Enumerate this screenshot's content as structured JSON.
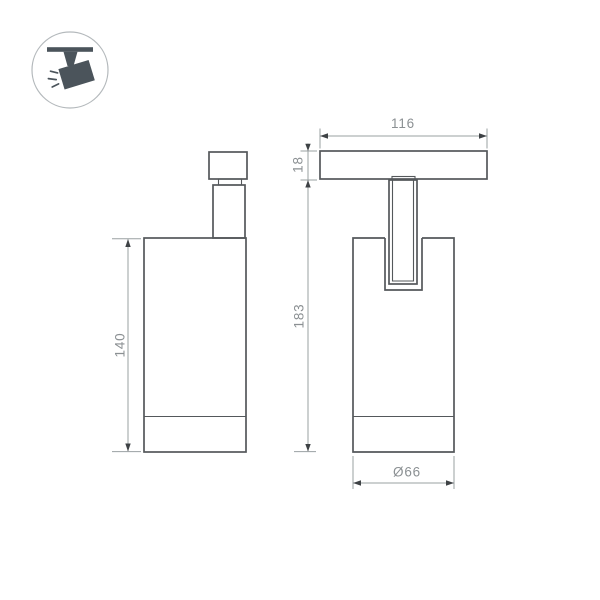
{
  "drawing": {
    "type": "technical-dimension-drawing",
    "subject": "track-mounted spotlight luminaire, two orthographic views",
    "colors": {
      "background": "#ffffff",
      "object-line": "#54585b",
      "dimension-line": "#9aa0a2",
      "dimension-text": "#8b9093",
      "arrow-fill": "#3e4245",
      "icon-fill": "#4b545b",
      "icon-circle-stroke": "#b4b9bc"
    },
    "icon": {
      "name": "track-spotlight-icon",
      "description": "circled pictogram of a spotlight hanging from a track with light rays"
    },
    "views": {
      "front": {
        "name": "front-view",
        "body_height_label": "140"
      },
      "side": {
        "name": "side-view",
        "track_width_label": "116",
        "track_height_label": "18",
        "total_height_label": "183",
        "diameter_label": "Ø66"
      }
    }
  }
}
